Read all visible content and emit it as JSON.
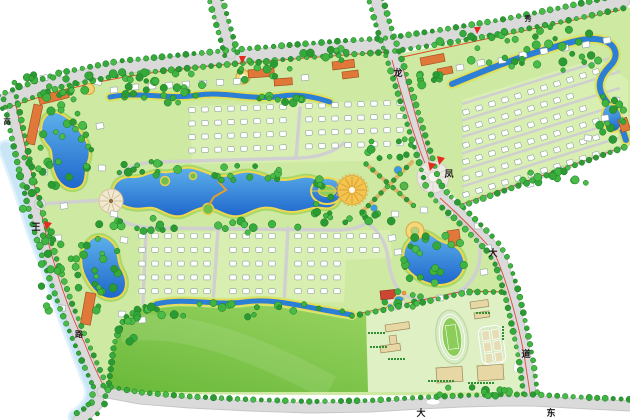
{
  "labels": {
    "left_road_top": "高",
    "left_road_entrance": "王",
    "left_road_bottom": "路",
    "top_road": "秀",
    "spine_road_1": "龙",
    "spine_road_2": "凤",
    "spine_road_3": "大",
    "spine_road_4": "道",
    "bottom_road_1": "大",
    "bottom_road_2": "东"
  },
  "icons": {
    "entrance_marker": "red-triangle",
    "tree": "green-circle",
    "house": "white-footprint"
  },
  "colors": {
    "water": "#2b7fd4",
    "water_light": "#5db0ea",
    "shore": "#edd84e",
    "river": "#c9e6f7",
    "road": "#dadada",
    "road_edge": "#c6c6c6",
    "tree": "#35a93b",
    "tree_dark": "#1c7a22",
    "parcel_green": "#cde9a2",
    "yard_green": "#d9efb2",
    "lawn": "#6fbe3c",
    "lawn_light": "#a9dc6e",
    "school_ground": "#def0c4",
    "building_tan": "#e6d7a4",
    "roof_orange": "#e0783a",
    "roof_red": "#cc4632",
    "boundary_red": "#e2301c",
    "plaza_yellow": "#f3c54f",
    "marker_red": "#e32b1e",
    "house": "#ffffff"
  }
}
